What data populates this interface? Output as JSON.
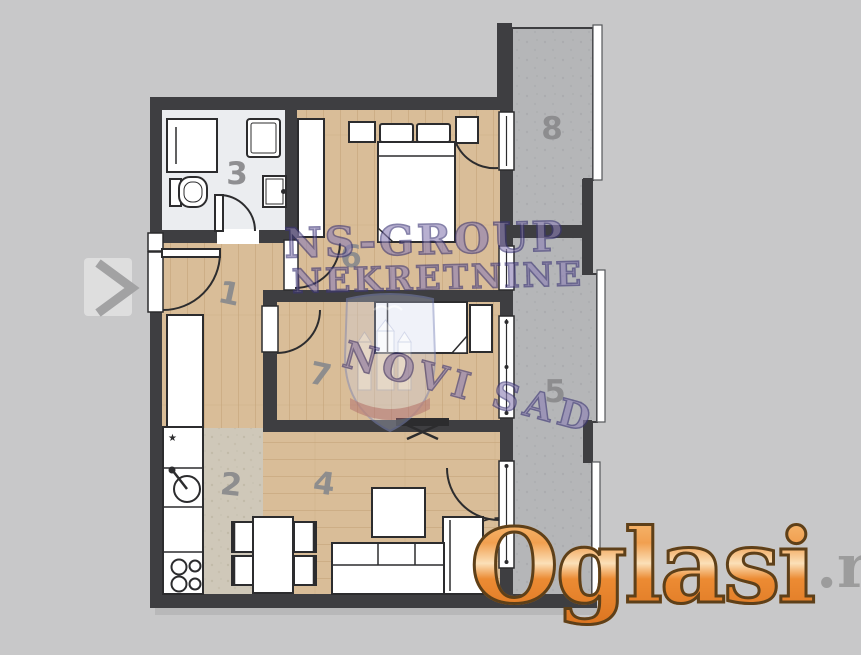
{
  "page": {
    "background": "#c8c8c9"
  },
  "floorplan": {
    "room_labels": [
      {
        "number": "1"
      },
      {
        "number": "2"
      },
      {
        "number": "3"
      },
      {
        "number": "4"
      },
      {
        "number": "5"
      },
      {
        "number": "6"
      },
      {
        "number": "7"
      },
      {
        "number": "8"
      }
    ],
    "colors": {
      "wall": "#3e3e41",
      "wood_floor": "#d9bd98",
      "tile_floor": "#cfc8b9",
      "bath_floor": "#ebedf0",
      "terrace": "#b5b6b8",
      "furniture": "#ffffff",
      "outline": "#2c2c2e",
      "label_gray": "#8b8b8d"
    }
  },
  "icons": {
    "fridge_star": "★"
  },
  "watermark": {
    "line1": "NS-GROUP",
    "line2": "NEKRETNINE",
    "stamp_text": "NOVI SAD",
    "color": "#8e81b6"
  },
  "logo": {
    "brand": "Oglasi",
    "tld": ".rs",
    "orange": "#ec8b33",
    "tld_color": "#9c9c9c"
  }
}
